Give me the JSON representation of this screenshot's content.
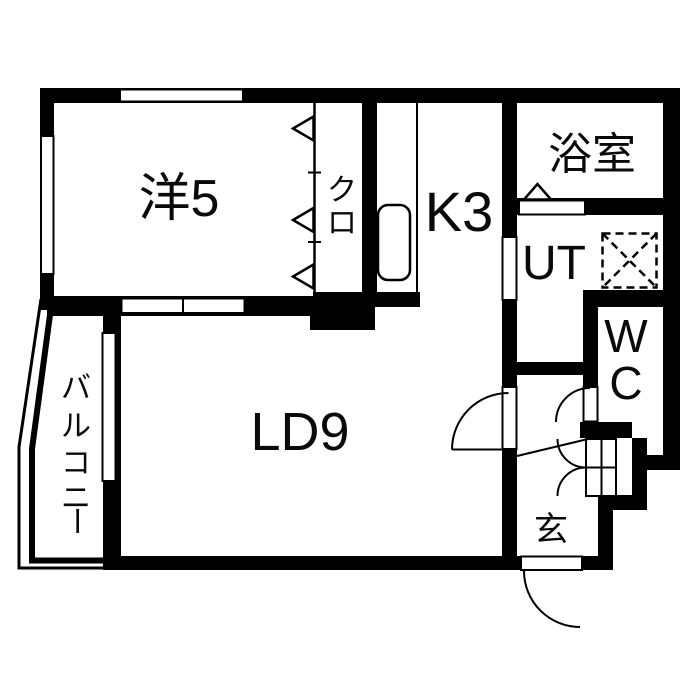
{
  "rooms": {
    "western_room": {
      "label": "洋5"
    },
    "closet": {
      "label": "クロ",
      "chars": [
        "ク",
        "ロ"
      ]
    },
    "kitchen": {
      "label": "K3"
    },
    "bathroom": {
      "label": "浴室"
    },
    "utility": {
      "label": "UT"
    },
    "toilet": {
      "label": "WC",
      "chars": [
        "W",
        "C"
      ]
    },
    "living_dining": {
      "label": "LD9"
    },
    "entrance": {
      "label": "玄"
    },
    "balcony": {
      "label": "バルコニー",
      "chars": [
        "バ",
        "ル",
        "コ",
        "ニ",
        "ー"
      ]
    }
  },
  "fixtures": {
    "sink": "kitchen-sink",
    "washing_machine": "washing-machine-space",
    "closet_door": "three-panel-folding-door",
    "bathroom_door": "bath-door-with-triangle-marker",
    "entry_door": "hinged-entry-door",
    "wc_door": "hinged-wc-door",
    "shoe_cabinet_door": "double-leaf-door",
    "partition": "two-pane-sliding-partition"
  },
  "colors": {
    "wall": "#000000",
    "floor": "#ffffff",
    "text": "#0a0a0a"
  }
}
